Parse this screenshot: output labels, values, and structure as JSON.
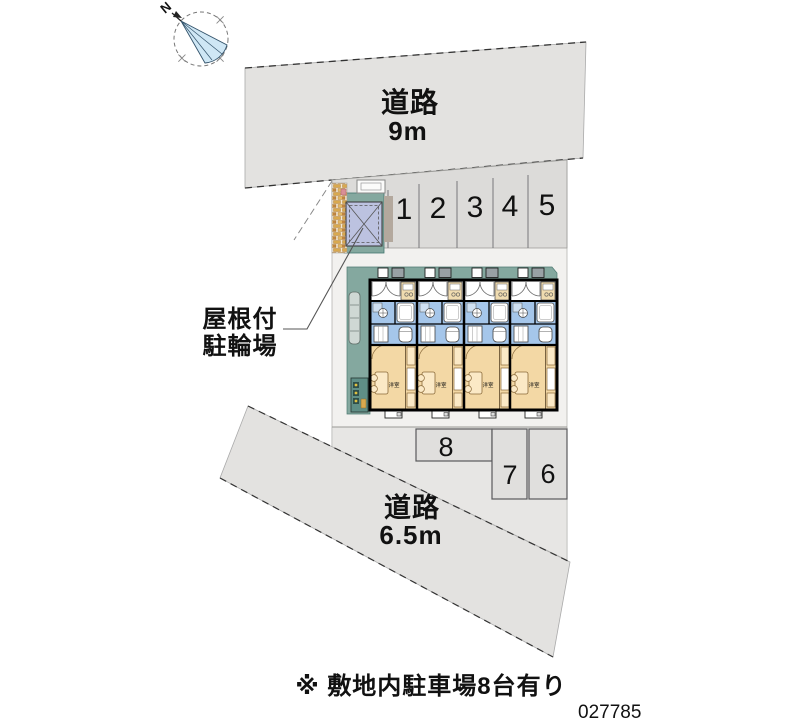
{
  "compass": {
    "north": "N"
  },
  "road_top": {
    "label": "道路",
    "width": "9m"
  },
  "road_bottom": {
    "label": "道路",
    "width": "6.5m"
  },
  "parking_row_top": {
    "spaces": [
      "1",
      "2",
      "3",
      "4",
      "5"
    ]
  },
  "parking_bottom": {
    "space_8": "8",
    "space_7": "7",
    "space_6": "6"
  },
  "bicycle_shed": {
    "label_line1": "屋根付",
    "label_line2": "駐輪場"
  },
  "building": {
    "room_label": "洋室"
  },
  "footer": {
    "note": "※ 敷地内駐車場8台有り",
    "plan_number": "027785"
  },
  "colors": {
    "road": "#e3e2e0",
    "parking": "#dcdbd9",
    "lower_lot": "#e7e6e4",
    "site": "#f2f1ef",
    "deck_teal": "#84a89f",
    "shed_roof": "#bcc2e0",
    "shed_base_gray": "#b3a89d",
    "room_tan": "#f3d8a5",
    "room_blue": "#a5c6ea",
    "fan_blue": "#cfe7f5"
  }
}
